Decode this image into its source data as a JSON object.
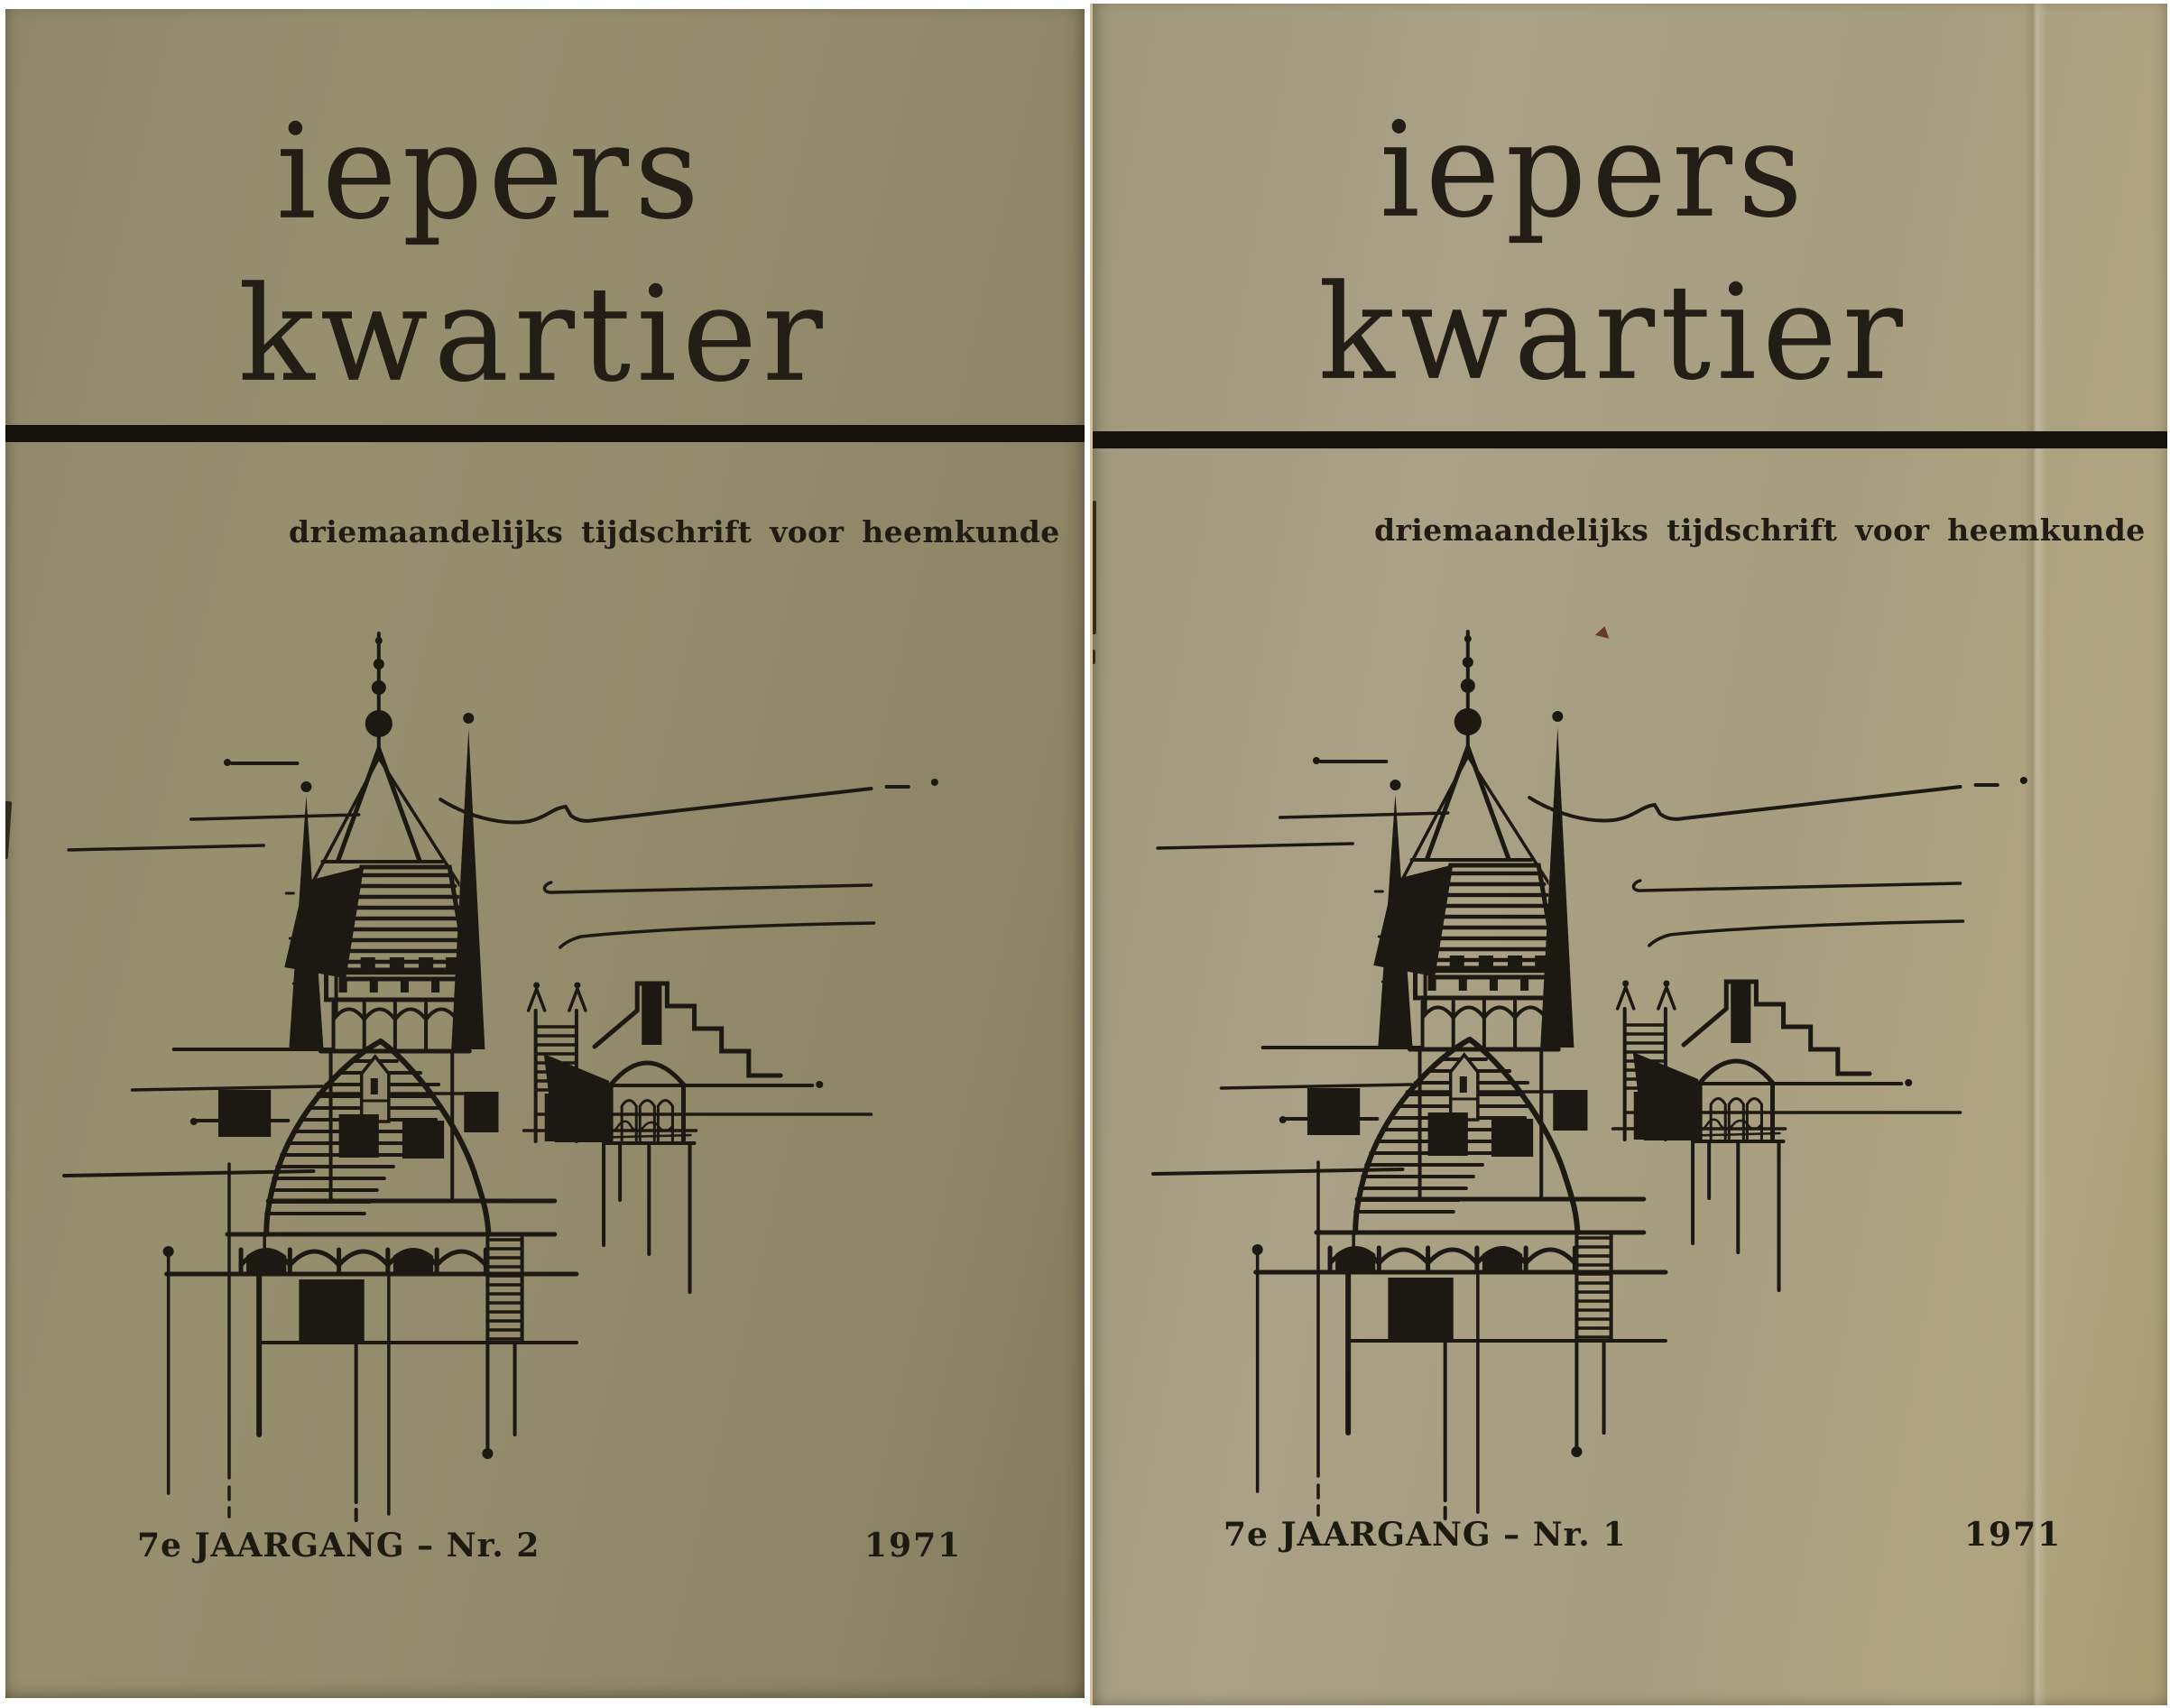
{
  "photo": {
    "description": "photograph of two issues of the magazine lying side by side on a white background",
    "background_color": "#ffffff"
  },
  "magazine": {
    "title_line1": "iepers",
    "title_line2": "kwartier",
    "subtitle": "driemaandelijks tijdschrift voor heemkunde"
  },
  "covers": [
    {
      "position": "left",
      "edition": "7e JAARGANG – Nr. 2",
      "year": "1971",
      "paper_color": "#938b6b",
      "ink_color": "#1d1a14"
    },
    {
      "position": "right",
      "edition": "7e JAARGANG – Nr. 1",
      "year": "1971",
      "paper_color": "#a89e81",
      "ink_color": "#1d1a14"
    }
  ],
  "divider_band_color": "#16130e",
  "illustration": {
    "subject": "pen-and-ink sketch of the medieval towers of Ypres (spire, belfry, stepped gable)",
    "ink_color": "#1c1913"
  }
}
